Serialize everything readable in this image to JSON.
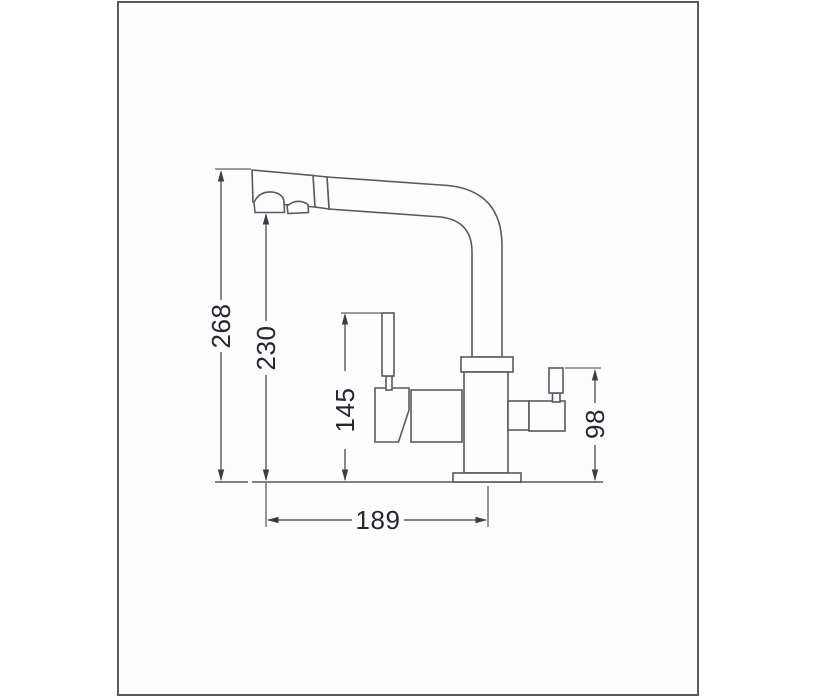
{
  "diagram": {
    "type": "technical-drawing",
    "subject": "kitchen faucet side elevation with dimension callouts",
    "dimensions": {
      "overall_height": {
        "value": "268",
        "orientation": "vertical"
      },
      "spout_outlet_height": {
        "value": "230",
        "orientation": "vertical"
      },
      "handle_top_height": {
        "value": "145",
        "orientation": "vertical"
      },
      "side_handle_height": {
        "value": "98",
        "orientation": "vertical"
      },
      "spout_reach": {
        "value": "189",
        "orientation": "horizontal"
      }
    },
    "colors": {
      "background": "#ffffff",
      "frame_border": "#595a5c",
      "outline": "#595a5c",
      "dimension_line": "#3d3d3f",
      "label_text": "#27272a"
    }
  }
}
